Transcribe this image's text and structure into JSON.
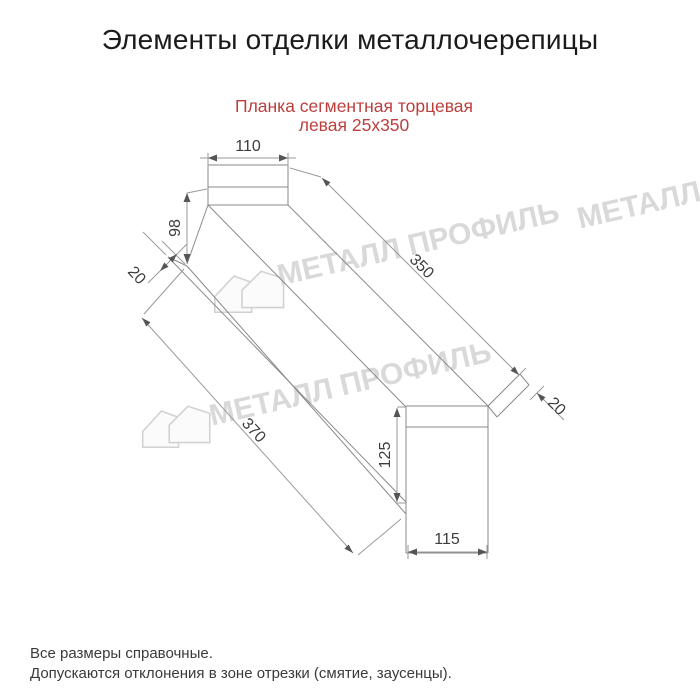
{
  "page": {
    "title": "Элементы отделки металлочерепицы"
  },
  "product": {
    "name_line1": "Планка сегментная торцевая",
    "name_line2": "левая 25х350"
  },
  "drawing": {
    "dimensions": {
      "top_cap_width": "110",
      "left_end_height": "98",
      "left_hem": "20",
      "flange_length": "350",
      "total_length": "370",
      "right_hem": "20",
      "right_end_height": "125",
      "right_end_width": "115"
    }
  },
  "watermark": {
    "text": "МЕТАЛЛ ПРОФИЛЬ"
  },
  "footer": {
    "note1": "Все размеры справочные.",
    "note2": "Допускаются отклонения в зоне отрезки (смятие, заусенцы)."
  },
  "colors": {
    "accent": "#bb3f3d",
    "line": "#8a8a8a",
    "watermark": "#d9d9d9"
  }
}
